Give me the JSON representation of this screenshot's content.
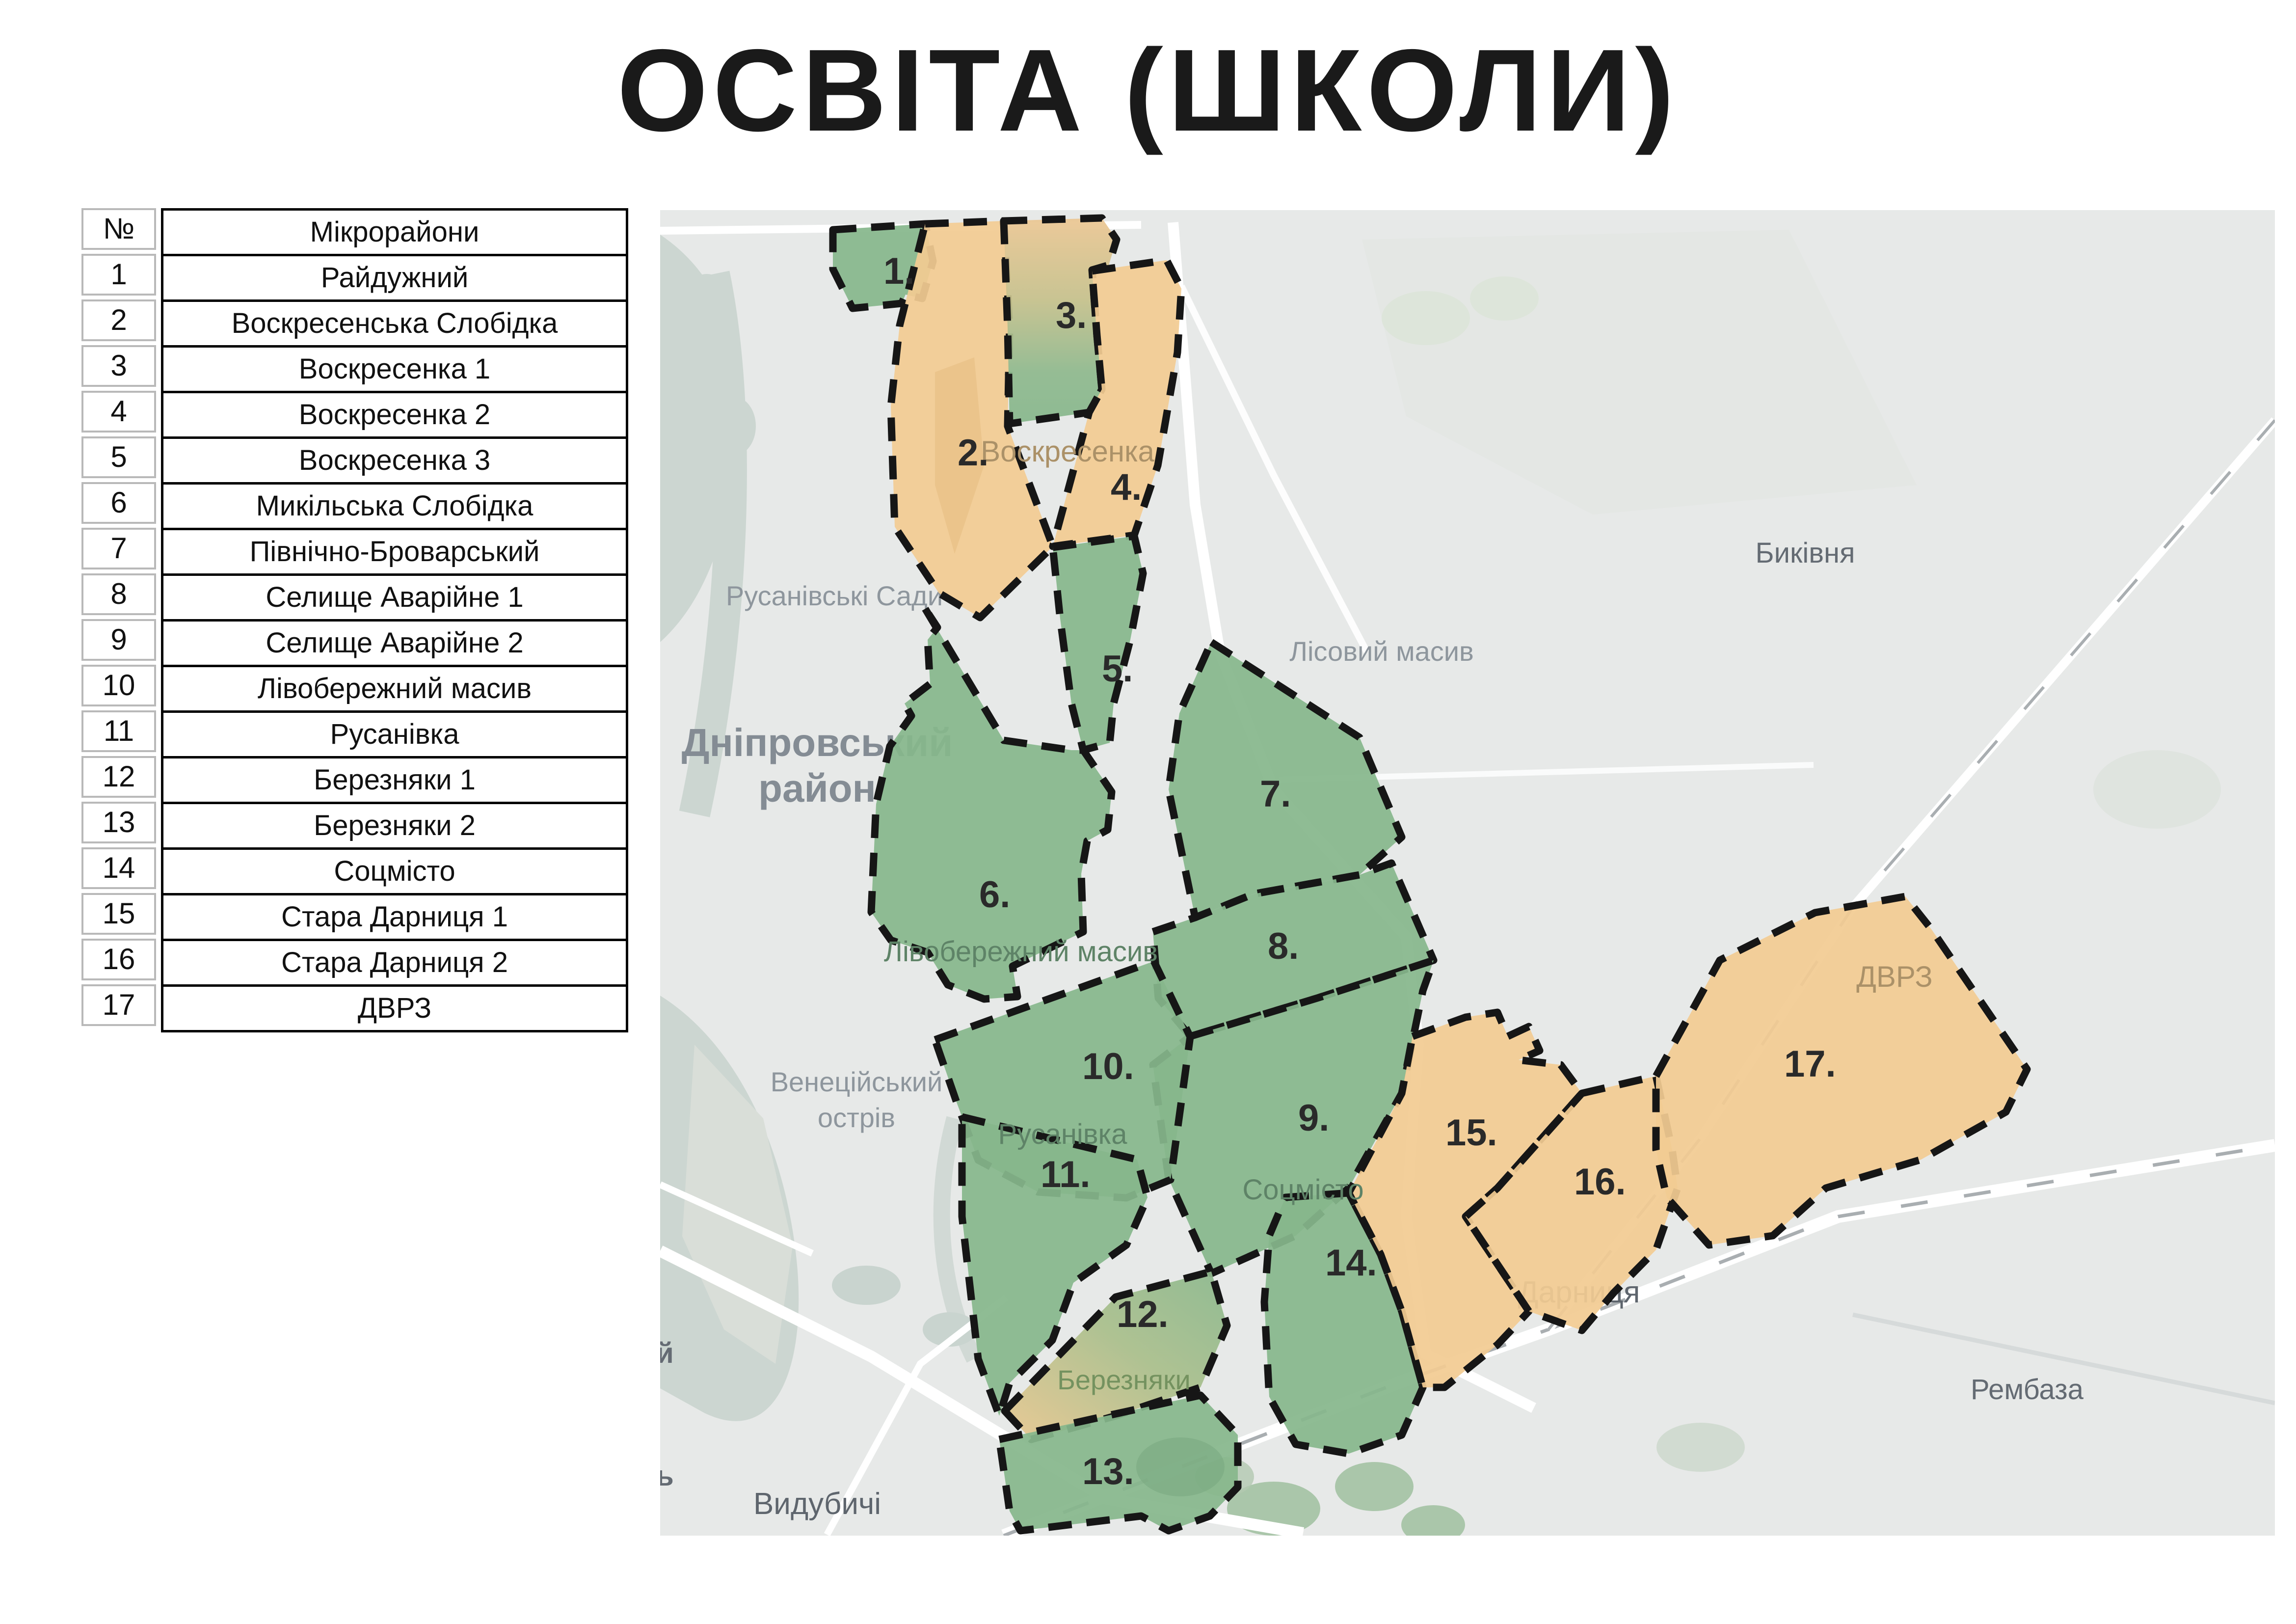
{
  "title": "ОСВІТА (ШКОЛИ)",
  "table": {
    "header": {
      "number": "№",
      "name": "Мікрорайони"
    },
    "rows": [
      {
        "num": "1",
        "name": "Райдужний"
      },
      {
        "num": "2",
        "name": "Воскресенська Слобідка"
      },
      {
        "num": "3",
        "name": "Воскресенка 1"
      },
      {
        "num": "4",
        "name": "Воскресенка 2"
      },
      {
        "num": "5",
        "name": "Воскресенка 3"
      },
      {
        "num": "6",
        "name": "Микільська Слобідка"
      },
      {
        "num": "7",
        "name": "Північно-Броварський"
      },
      {
        "num": "8",
        "name": "Селище Аварійне 1"
      },
      {
        "num": "9",
        "name": "Селище Аварійне 2"
      },
      {
        "num": "10",
        "name": "Лівобережний масив"
      },
      {
        "num": "11",
        "name": "Русанівка"
      },
      {
        "num": "12",
        "name": "Березняки 1"
      },
      {
        "num": "13",
        "name": "Березняки 2"
      },
      {
        "num": "14",
        "name": "Соцмісто"
      },
      {
        "num": "15",
        "name": "Стара Дарниця 1"
      },
      {
        "num": "16",
        "name": "Стара Дарниця 2"
      },
      {
        "num": "17",
        "name": "ДВРЗ"
      }
    ]
  },
  "map": {
    "palette": {
      "region_green": "#87b78c",
      "region_orange": "#f2cb92",
      "region_border": "#161616",
      "map_background": "#e7e9e8",
      "water": "#ccd6d1",
      "road": "#ffffff",
      "title_color": "#1a1a1a"
    },
    "regions": [
      {
        "num": "1",
        "label": "1.",
        "name": "Райдужний",
        "color": "green"
      },
      {
        "num": "2",
        "label": "2.",
        "name": "Воскресенська Слобідка",
        "color": "orange"
      },
      {
        "num": "3",
        "label": "3.",
        "name": "Воскресенка 1",
        "color": "gradient-orange-to-green"
      },
      {
        "num": "4",
        "label": "4.",
        "name": "Воскресенка 2",
        "color": "orange"
      },
      {
        "num": "5",
        "label": "5.",
        "name": "Воскресенка 3",
        "color": "green"
      },
      {
        "num": "6",
        "label": "6.",
        "name": "Микільська Слобідка",
        "color": "green"
      },
      {
        "num": "7",
        "label": "7.",
        "name": "Північно-Броварський",
        "color": "green"
      },
      {
        "num": "8",
        "label": "8.",
        "name": "Селище Аварійне 1",
        "color": "green"
      },
      {
        "num": "9",
        "label": "9.",
        "name": "Селище Аварійне 2",
        "color": "green"
      },
      {
        "num": "10",
        "label": "10.",
        "name": "Лівобережний масив",
        "color": "green"
      },
      {
        "num": "11",
        "label": "11.",
        "name": "Русанівка",
        "color": "green"
      },
      {
        "num": "12",
        "label": "12.",
        "name": "Березняки 1",
        "color": "gradient-orange-to-green"
      },
      {
        "num": "13",
        "label": "13.",
        "name": "Березняки 2",
        "color": "green"
      },
      {
        "num": "14",
        "label": "14.",
        "name": "Соцмісто",
        "color": "green"
      },
      {
        "num": "15",
        "label": "15.",
        "name": "Стара Дарниця 1",
        "color": "orange"
      },
      {
        "num": "16",
        "label": "16.",
        "name": "Стара Дарниця 2",
        "color": "orange"
      },
      {
        "num": "17",
        "label": "17.",
        "name": "ДВРЗ",
        "color": "orange"
      }
    ],
    "base_labels": [
      {
        "id": "rusanivski-sady",
        "text": "Русанівські Сади"
      },
      {
        "id": "dniprovskyi-raion-line1",
        "text": "Дніпровський"
      },
      {
        "id": "dniprovskyi-raion-line2",
        "text": "район"
      },
      {
        "id": "lisovyi-masyv",
        "text": "Лісовий масив"
      },
      {
        "id": "bykivnia",
        "text": "Биківня"
      },
      {
        "id": "venetsiiskyi-ostriv-line1",
        "text": "Венеційський"
      },
      {
        "id": "venetsiiskyi-ostriv-line2",
        "text": "острів"
      },
      {
        "id": "vydubychi",
        "text": "Видубичі"
      },
      {
        "id": "darnytsia",
        "text": "Дарниця"
      },
      {
        "id": "rembaza",
        "text": "Рембаза"
      },
      {
        "id": "cut-letter-top",
        "text": "й"
      },
      {
        "id": "cut-letter-bottom",
        "text": "ь"
      }
    ],
    "area_labels": [
      {
        "id": "voskresenka",
        "text": "Воскресенка"
      },
      {
        "id": "livoberezhnyi-masyv",
        "text": "Лівобережний масив"
      },
      {
        "id": "sotsmisto",
        "text": "Соцмісто"
      },
      {
        "id": "rusanivka",
        "text": "Русанівка"
      },
      {
        "id": "berezniaky",
        "text": "Березняки"
      },
      {
        "id": "dvrz",
        "text": "ДВРЗ"
      }
    ]
  }
}
